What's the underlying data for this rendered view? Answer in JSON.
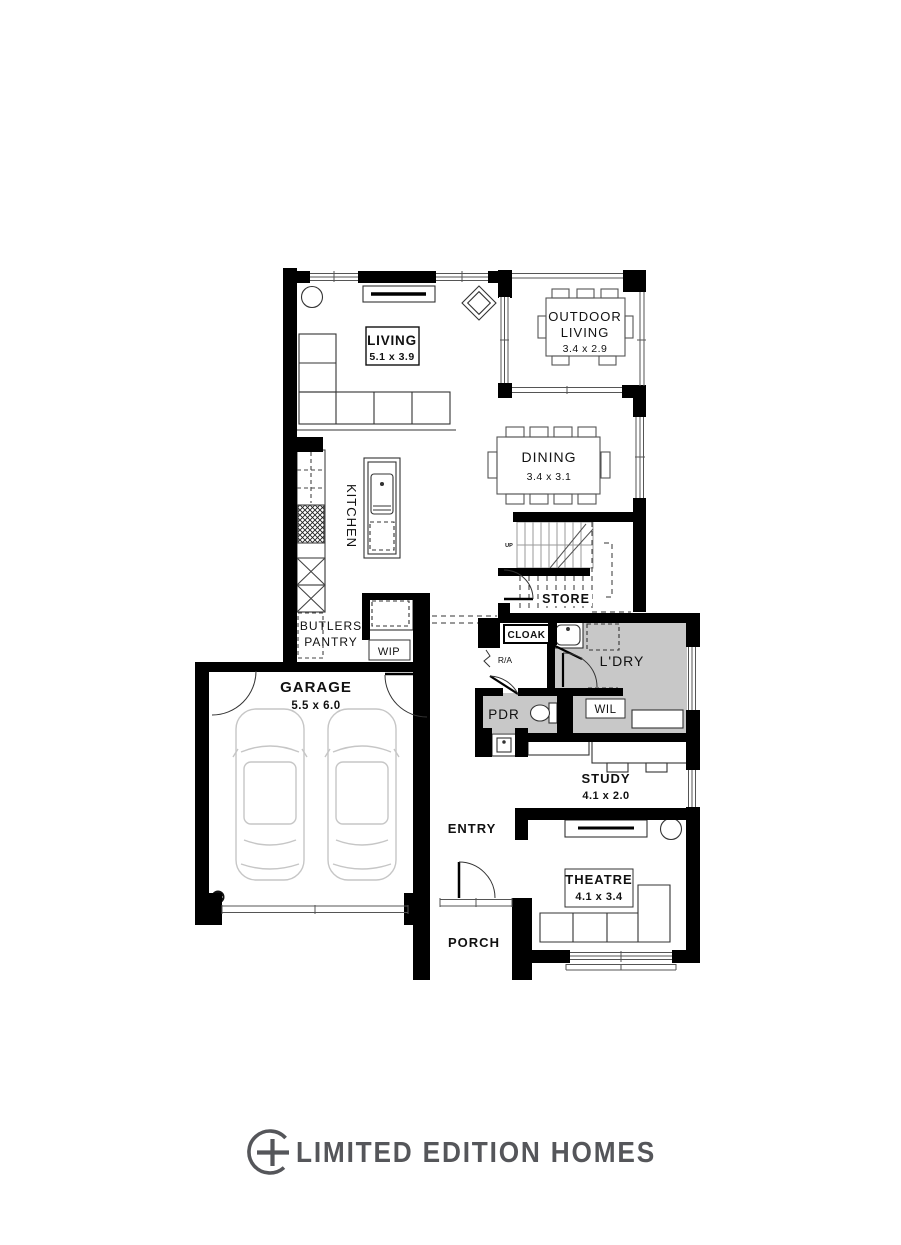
{
  "rooms": {
    "living": {
      "name": "LIVING",
      "dims": "5.1 x 3.9"
    },
    "outdoor_living": {
      "line1": "OUTDOOR",
      "line2": "LIVING",
      "dims": "3.4 x 2.9"
    },
    "dining": {
      "name": "DINING",
      "dims": "3.4 x 3.1"
    },
    "kitchen": {
      "name": "KITCHEN"
    },
    "stairs": {
      "up_label": "UP"
    },
    "store": {
      "name": "STORE"
    },
    "butlers_pantry": {
      "line1": "BUTLERS",
      "line2": "PANTRY"
    },
    "wip": {
      "name": "WIP"
    },
    "cloak": {
      "name": "CLOAK"
    },
    "return_air": {
      "name": "R/A"
    },
    "laundry": {
      "name": "L'DRY"
    },
    "powder": {
      "name": "PDR"
    },
    "linen": {
      "name": "WIL"
    },
    "garage": {
      "name": "GARAGE",
      "dims": "5.5 x 6.0"
    },
    "study": {
      "name": "STUDY",
      "dims": "4.1 x 2.0"
    },
    "entry": {
      "name": "ENTRY"
    },
    "theatre": {
      "name": "THEATRE",
      "dims": "4.1 x 3.4"
    },
    "porch": {
      "name": "PORCH"
    }
  },
  "footer": {
    "brand": "LIMITED EDITION HOMES"
  },
  "colors": {
    "wall": "#000000",
    "room_shading": "#c8c8c8",
    "brand": "#55565a"
  }
}
